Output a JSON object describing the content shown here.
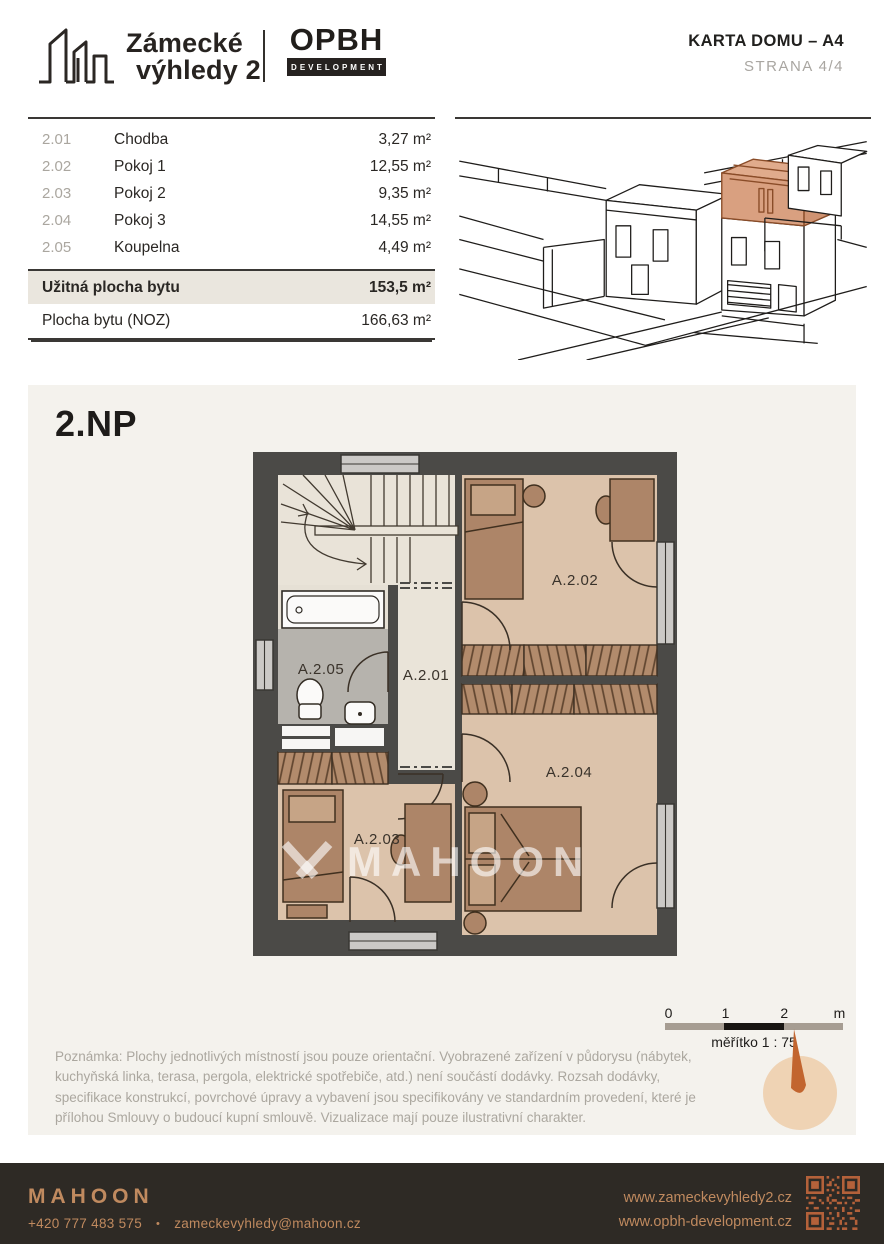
{
  "header": {
    "brand_line1": "Zámecké",
    "brand_line2": "výhledy 2",
    "partner_name": "OPBH",
    "partner_sub": "DEVELOPMENT",
    "doc_title": "KARTA DOMU – A4",
    "page_label": "STRANA  4/4"
  },
  "room_table": {
    "rows": [
      {
        "code": "2.01",
        "name": "Chodba",
        "area": "3,27 m²"
      },
      {
        "code": "2.02",
        "name": "Pokoj 1",
        "area": "12,55 m²"
      },
      {
        "code": "2.03",
        "name": "Pokoj 2",
        "area": "9,35 m²"
      },
      {
        "code": "2.04",
        "name": "Pokoj 3",
        "area": "14,55 m²"
      },
      {
        "code": "2.05",
        "name": "Koupelna",
        "area": "4,49 m²"
      }
    ],
    "totals": [
      {
        "label": "Užitná plocha bytu",
        "value": "153,5 m²"
      },
      {
        "label": "Plocha bytu (NOZ)",
        "value": "166,63 m²"
      }
    ]
  },
  "plan": {
    "floor_label": "2.NP",
    "rooms": {
      "a201": "A.2.01",
      "a202": "A.2.02",
      "a203": "A.2.03",
      "a204": "A.2.04",
      "a205": "A.2.05"
    },
    "watermark": "MAHOON",
    "scale_bar": {
      "tick0": "0",
      "tick1": "1",
      "tick2": "2",
      "unit": "m",
      "label": "měřítko 1 : 75"
    }
  },
  "note": "Poznámka: Plochy jednotlivých místností jsou pouze orientační. Vyobrazené zařízení v půdorysu (nábytek, kuchyňská linka, terasa, pergola, elektrické spotřebiče, atd.) není součástí dodávky. Rozsah dodávky, specifikace konstrukcí, povrchové úpravy a vybavení jsou specifikovány ve standardním provedení, které je přílohou Smlouvy o budoucí kupní smlouvě. Vizualizace mají pouze ilustrativní charakter.",
  "footer": {
    "brand": "MAHOON",
    "phone": "+420 777 483 575",
    "bullet": "•",
    "email": "zameckevyhledy@mahoon.cz",
    "website_primary": "www.zameckevyhledy2.cz",
    "website_secondary": "www.opbh-development.cz"
  },
  "colors": {
    "highlight_unit": "#d9a080",
    "copper": "#c08a5f",
    "qr_orange": "#b4613a",
    "wall": "#4b4a47",
    "panel_bg": "#f4f2ed"
  }
}
